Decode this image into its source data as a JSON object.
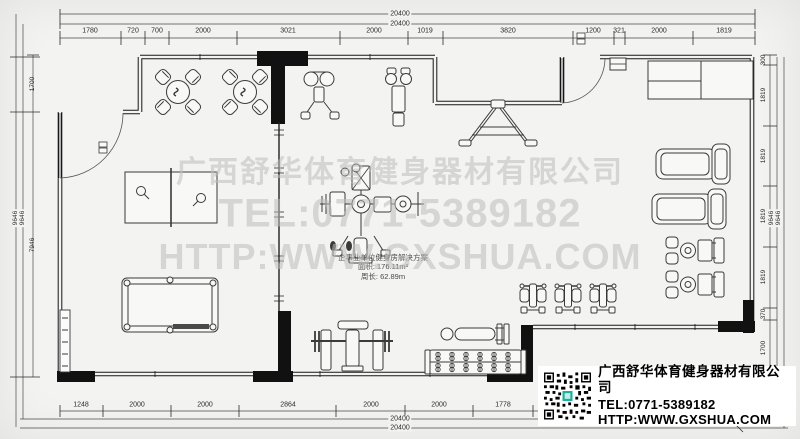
{
  "watermark": {
    "company": "广西舒华体育健身器材有限公司",
    "tel": "TEL:0771-5389182",
    "url": "HTTP:WWW.GXSHUA.COM"
  },
  "info_box": {
    "company": "广西舒华体育健身器材有限公司",
    "tel": "TEL:0771-5389182",
    "url": "HTTP:WWW.GXSHUA.COM",
    "qr_icon": "qr-code"
  },
  "plan_label": {
    "title": "企事业单位健身房解决方案",
    "area": "面积: 176.11m²",
    "perimeter": "周长: 62.89m"
  },
  "dims": {
    "top_total": "20400",
    "bottom_total": "20400",
    "side_total": "9646",
    "top": [
      "1780",
      "720",
      "700",
      "2000",
      "3021",
      "2000",
      "1019",
      "3820",
      "1200",
      "321",
      "2000",
      "1819"
    ],
    "bottom": [
      "1248",
      "2000",
      "2000",
      "2864",
      "2000",
      "2000",
      "1778"
    ],
    "left": [
      "1700",
      "7946"
    ],
    "right": [
      "300",
      "1819",
      "1819",
      "1819",
      "1819",
      "370",
      "1700"
    ]
  },
  "colors": {
    "background": "#f3f3f2",
    "wall": "#161616",
    "line": "#3a3a3a",
    "watermark": "#bdbdbd",
    "qr_accent": "#1ab09c"
  }
}
